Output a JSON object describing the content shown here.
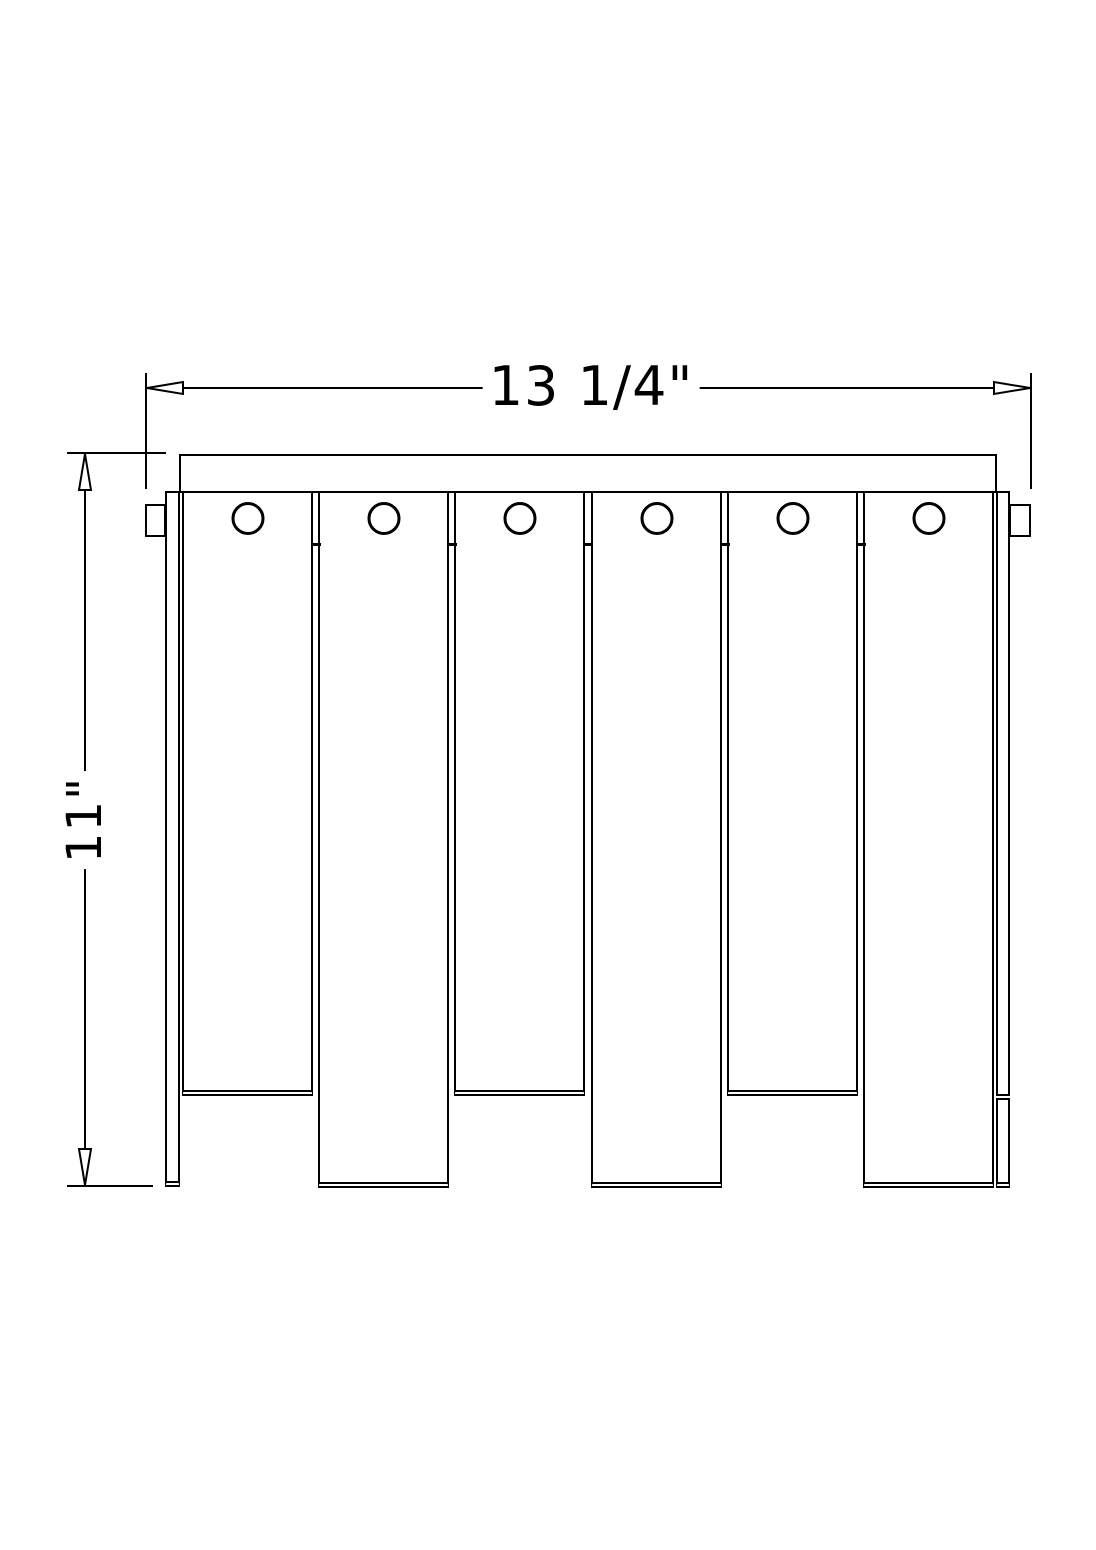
{
  "figure": {
    "type": "technical-dimension-drawing",
    "background_color": "#ffffff",
    "line_color": "#000000",
    "description_visible_parts": {
      "slat_count": 6,
      "hole_count": 6,
      "mount_tab_count": 2
    }
  },
  "dimensions": {
    "width": {
      "label": "13 1/4\""
    },
    "height": {
      "label": "11\""
    }
  }
}
